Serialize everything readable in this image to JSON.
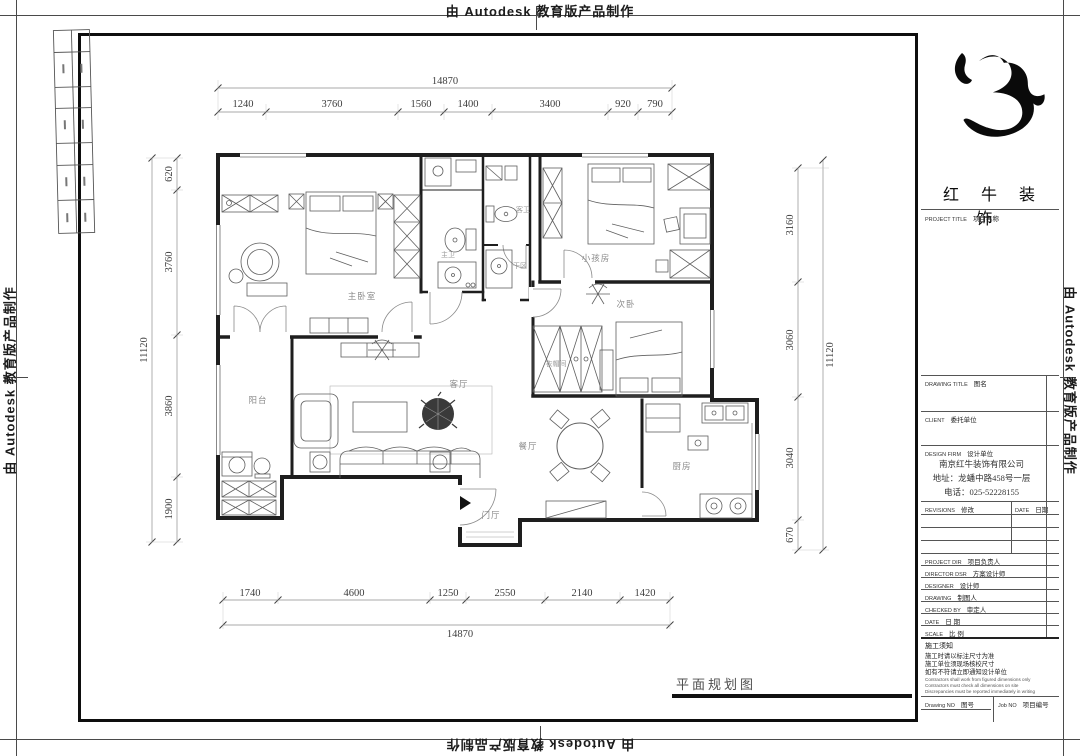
{
  "watermark": {
    "text": "由 Autodesk 教育版产品制作"
  },
  "sheet": {
    "caption": "平面规划图"
  },
  "rooms": {
    "master_bedroom": "主卧室",
    "master_bath": "主卫",
    "guest_bath": "客卫",
    "dry_area": "干区",
    "kids_room": "小孩房",
    "second_bedroom": "次卧",
    "cloakroom": "衣帽间",
    "balcony": "阳台",
    "living_room": "客厅",
    "dining_room": "餐厅",
    "kitchen": "厨房",
    "entry": "门厅"
  },
  "dims": {
    "top": {
      "total": "14870",
      "segments": [
        "1240",
        "3760",
        "1560",
        "1400",
        "3400",
        "920",
        "790"
      ]
    },
    "bottom": {
      "total": "14870",
      "segments": [
        "1740",
        "4600",
        "1250",
        "2550",
        "2140",
        "1420"
      ]
    },
    "left": {
      "total": "11120",
      "segments": [
        "620",
        "3760",
        "3860",
        "1900"
      ]
    },
    "right": {
      "total": "11120",
      "segments": [
        "3160",
        "3060",
        "3040",
        "670"
      ]
    }
  },
  "title_block": {
    "brand": "红 牛 装 饰",
    "project_title": {
      "en": "PROJECT TITLE",
      "cn": "项目名称"
    },
    "drawing_title": {
      "en": "DRAWING TITLE",
      "cn": "图名"
    },
    "client": {
      "en": "CLIENT",
      "cn": "委托单位"
    },
    "design_firm": {
      "en": "DESIGN FIRM",
      "cn": "设计单位"
    },
    "company": {
      "name": "南京红牛装饰有限公司",
      "address": "地址：龙蟠中路458号一层",
      "phone": "电话：025-52228155"
    },
    "revisions": {
      "en": "REVISIONS",
      "cn": "修改"
    },
    "date_col": {
      "en": "DATE",
      "cn": "日期"
    },
    "fields": [
      {
        "en": "PROJECT DIR",
        "cn": "项目负责人"
      },
      {
        "en": "DIRECTOR DSR",
        "cn": "方案设计师"
      },
      {
        "en": "DESIGNER",
        "cn": "设计师"
      },
      {
        "en": "DRAWING",
        "cn": "制图人"
      },
      {
        "en": "CHECKED BY",
        "cn": "审定人"
      },
      {
        "en": "DATE",
        "cn": "日 期"
      },
      {
        "en": "SCALE",
        "cn": "比 例"
      }
    ],
    "notes_title": "施工须知",
    "notes_cn": [
      "施工时请以标注尺寸为准",
      "施工单位须现场核校尺寸",
      "如有不符请立即通知设计单位"
    ],
    "notes_en": [
      "Contractors shall work from figured dimensions only",
      "Contractors must check all dimensions on site",
      "Discrepancies must be reported immediately in writing"
    ],
    "drawing_no": {
      "en": "Drawing NO",
      "cn": "图号"
    },
    "job_no": {
      "en": "Job NO",
      "cn": "项目编号"
    }
  }
}
